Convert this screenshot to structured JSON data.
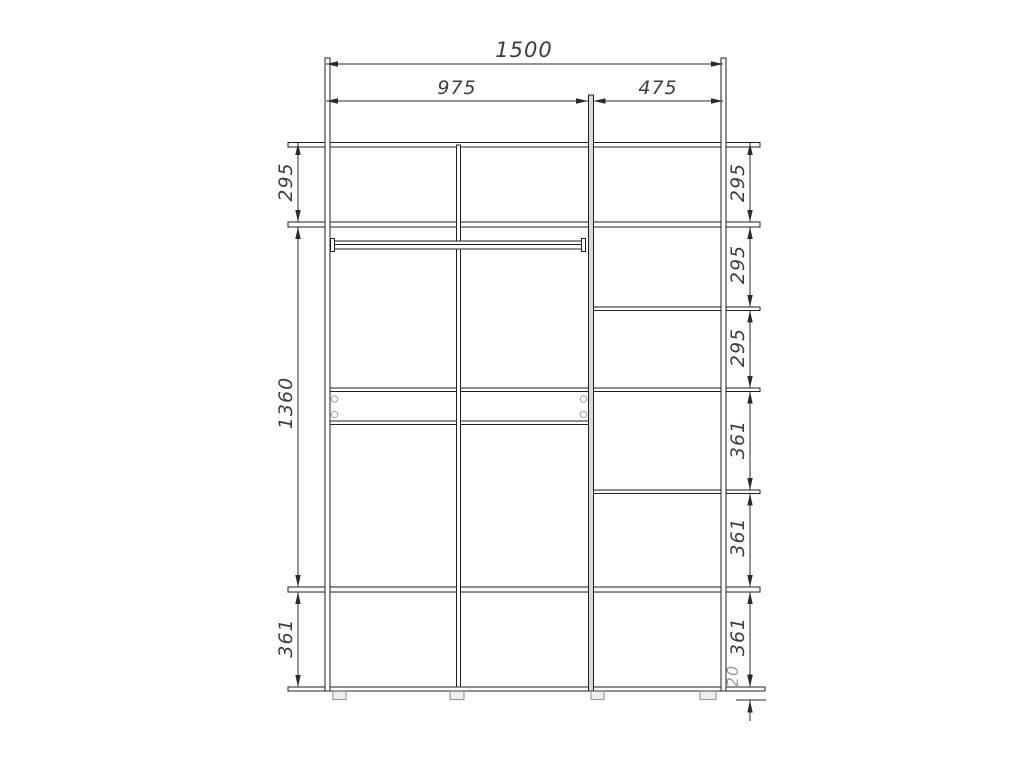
{
  "drawing": {
    "kind": "wardrobe-front-elevation-dimension-drawing",
    "colors": {
      "background": "#ffffff",
      "line": "#1f1f1f",
      "dim_line": "#2a2a2a",
      "dim_text": "#3d3d3d",
      "light_grey": "#9b9b9b",
      "panel_fill": "#d9d9d9"
    },
    "dims": {
      "width": {
        "overall": "1500",
        "left_section": "975",
        "right_section": "475"
      },
      "left_heights": {
        "top": "295",
        "middle": "1360",
        "bottom": "361"
      },
      "right_heights": {
        "s1": "295",
        "s2": "295",
        "s3": "295",
        "s4": "361",
        "s5": "361",
        "s6": "361",
        "base": "20"
      }
    }
  }
}
